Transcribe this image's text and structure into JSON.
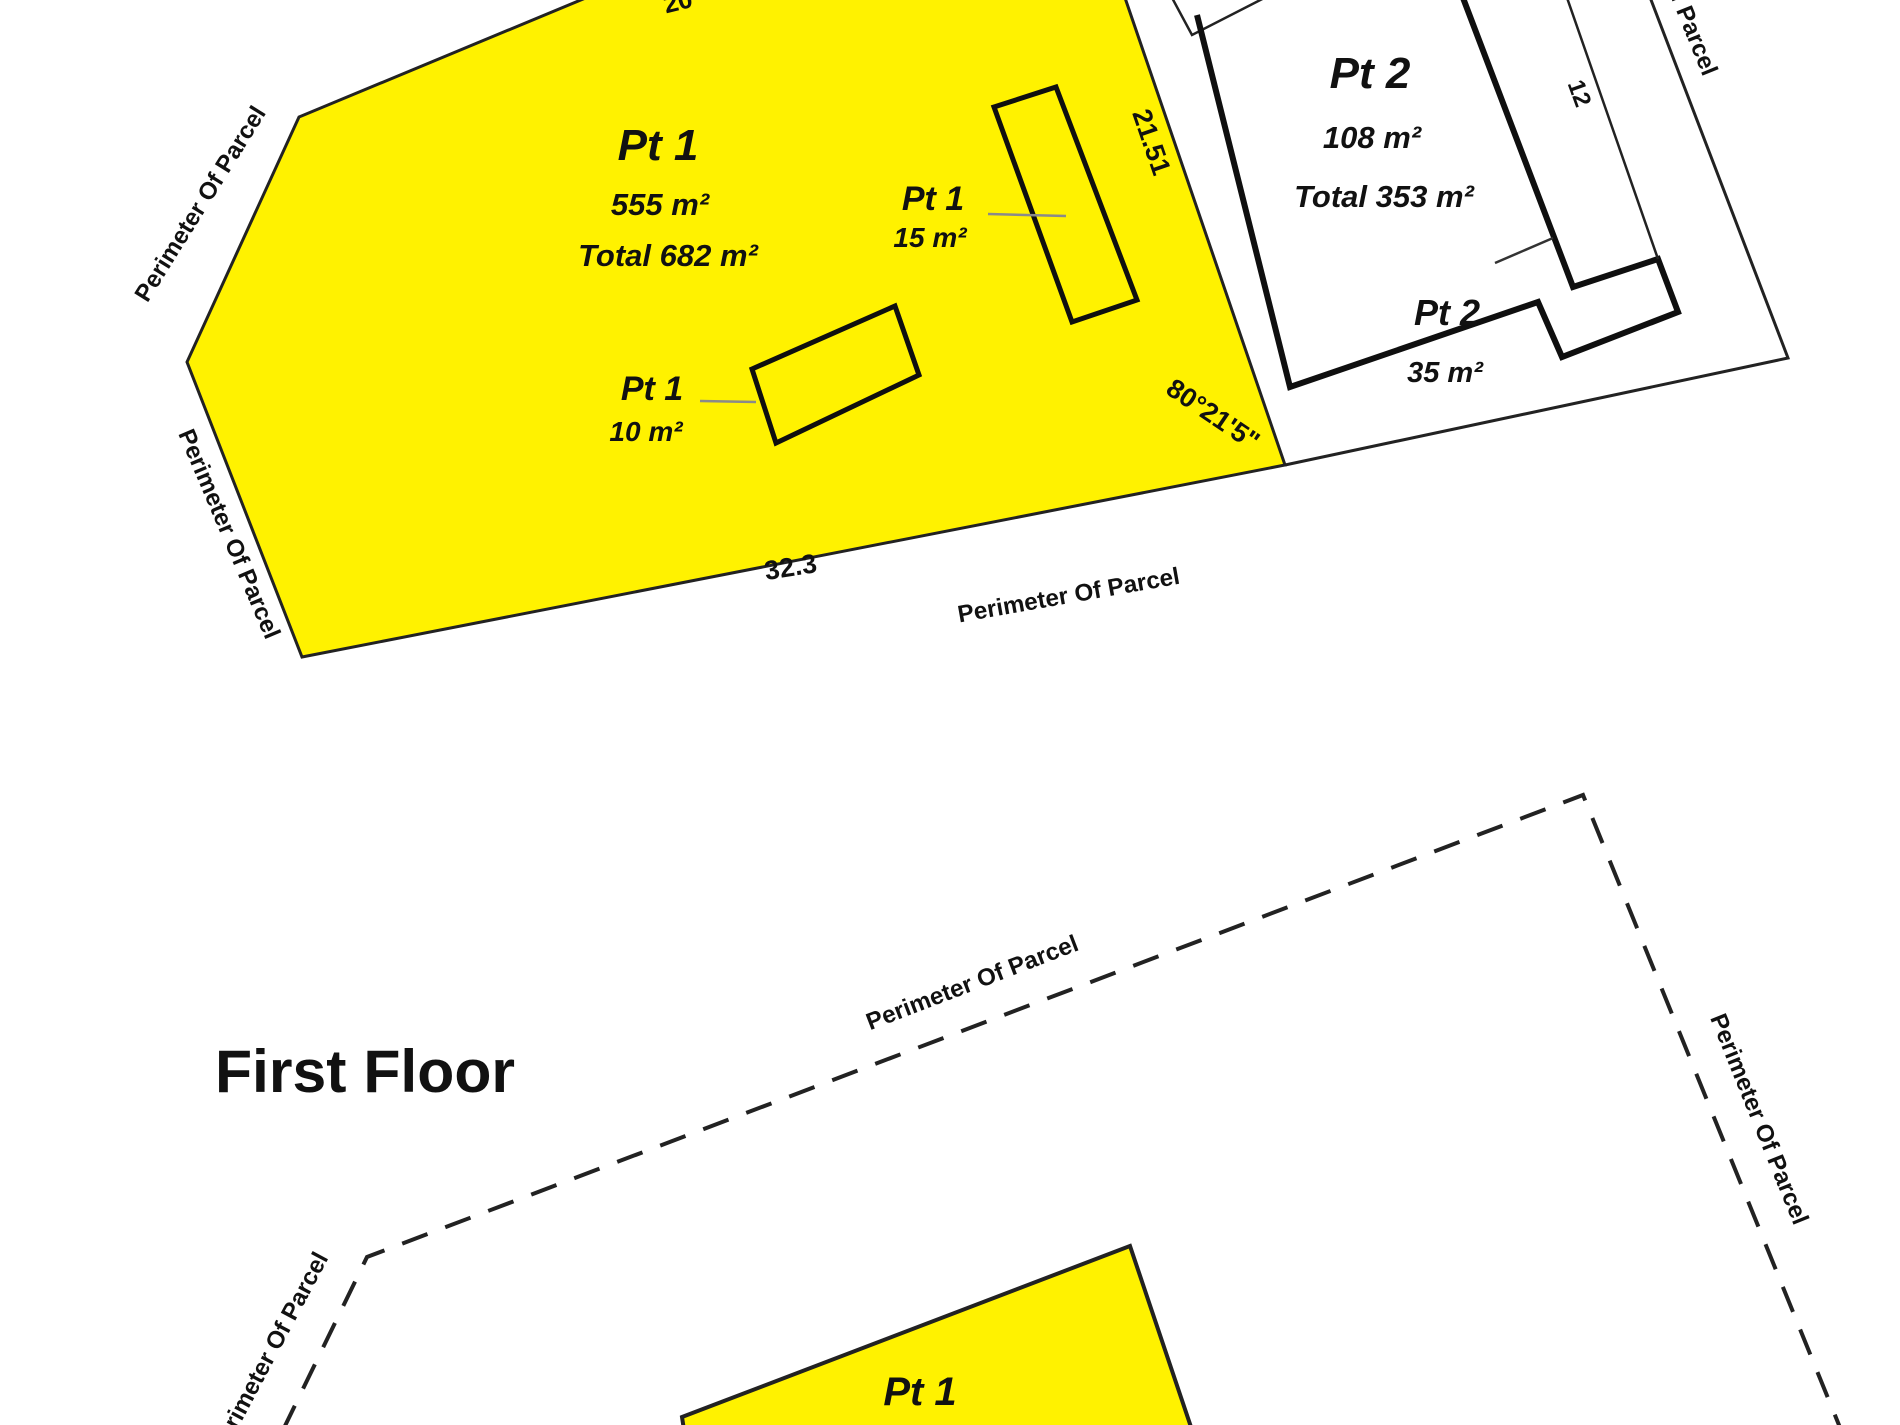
{
  "colors": {
    "parcel_yellow": "#FFF200",
    "line_dark": "#1f1f1f",
    "leader_gray": "#8a8a8a",
    "background": "#ffffff",
    "text": "#111111"
  },
  "ground_floor": {
    "parcel_pt1": {
      "name": "Pt 1",
      "area": "555 m²",
      "total": "Total 682 m²"
    },
    "outbuilding_15": {
      "name": "Pt 1",
      "area": "15 m²"
    },
    "outbuilding_10": {
      "name": "Pt 1",
      "area": "10 m²"
    },
    "parcel_pt2": {
      "name": "Pt 2",
      "area": "108 m²",
      "total": "Total 353 m²"
    },
    "parcel_pt2_part": {
      "name": "Pt 2",
      "area": "35 m²"
    },
    "dimensions": {
      "right_edge": "21.51",
      "bottom_edge": "32.3",
      "bearing": "80°21'5\"",
      "strip_width": "12",
      "top_edge_partial": "20"
    },
    "perimeter_label": "Perimeter Of Parcel"
  },
  "first_floor": {
    "title": "First Floor",
    "parcel_pt1": {
      "name": "Pt 1"
    },
    "perimeter_label": "Perimeter Of Parcel"
  }
}
